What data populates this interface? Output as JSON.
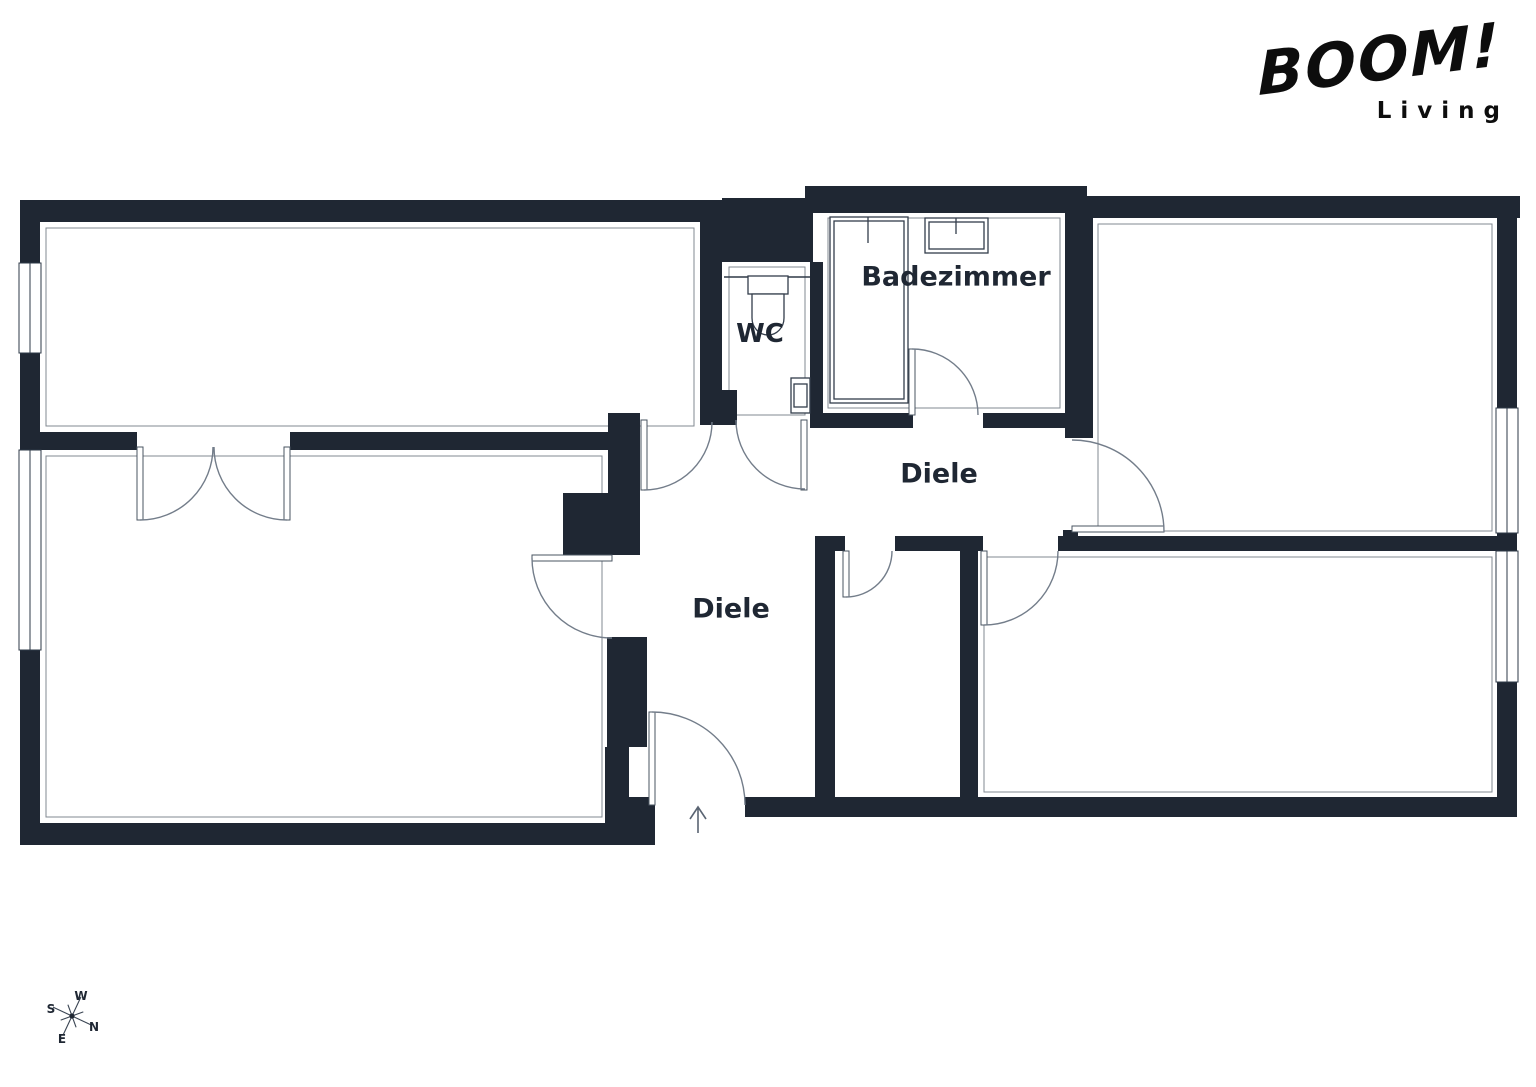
{
  "logo": {
    "brand": "BOOM!",
    "subtitle": "Living"
  },
  "labels": {
    "badezimmer": "Badezimmer",
    "wc": "WC",
    "diele_upper": "Diele",
    "diele_lower": "Diele"
  },
  "compass": {
    "n": "N",
    "e": "E",
    "s": "S",
    "w": "W"
  },
  "colors": {
    "wall": "#1F2733",
    "door_line": "#737D8A",
    "fixture_line": "#333D4B",
    "label_text": "#1F2733",
    "logo_text": "#0D0D0D",
    "background": "#FFFFFF"
  }
}
